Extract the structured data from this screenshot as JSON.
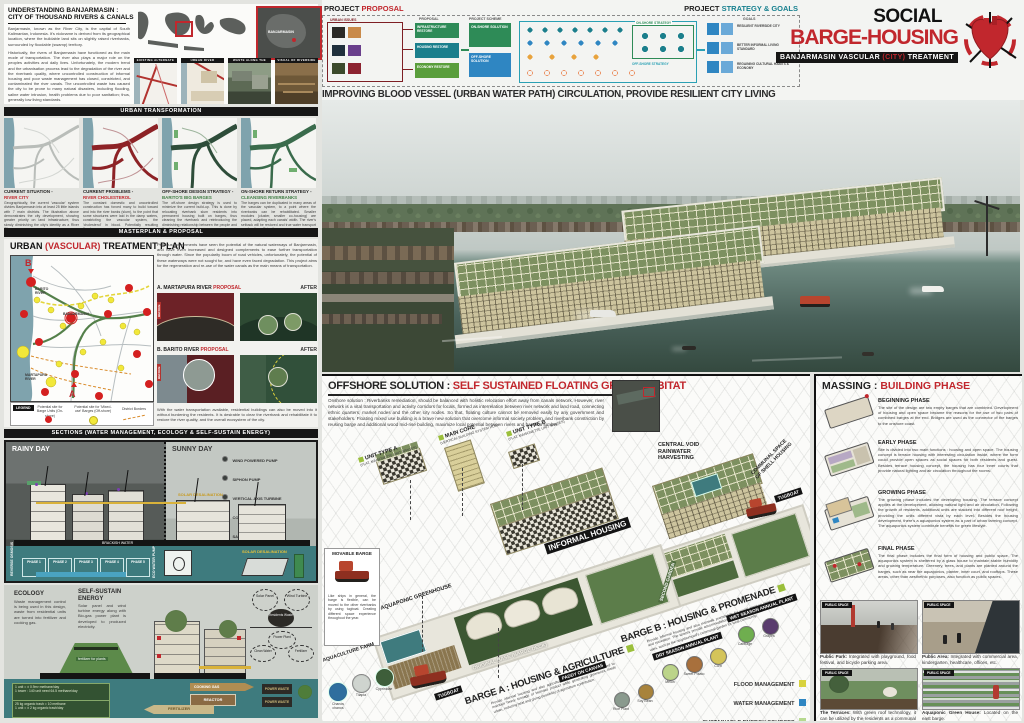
{
  "colors": {
    "accent_red": "#c1272d",
    "teal": "#17808f",
    "green": "#3f7d44",
    "flood": "#d8d23e",
    "water": "#2f86c2",
    "energy": "#b7d98f",
    "socio": "#55a14e",
    "map_river": "#7fa3ad"
  },
  "intro": {
    "title1": "UNDERSTANDING BANJARMASIN :",
    "title2": "CITY OF THOUSAND RIVERS & CANALS",
    "p1": "Banjarmasin, known as the River City, is the capital of South Kalimantan, Indonesia. It's nickname is derived from its geographical location, where the buildable land sits on slightly raised riverbanks, surrounded by floodable (swamp) territory.",
    "p2": "Historically, the rivers of Banjarmasin have functioned as the main mode of transportation. The river also plays a major role on the peoples activities and daily lives. Unfortunately, the modern trend and the urbanisation process lead to the degradation of the river and the riverbank quality, where uncontrolled construction of informal housing and poor waste management has closed, constricted, and contaminated the river canals. The uncontrolled waste has caused the city to be prone to many natural disasters, including flooding, saline water intrusion, health problems due to poor sanitation; thus, generally low living standards.",
    "inset_label": "BANJARMASIN",
    "thumbs": [
      "EXISTING ALTERNATE CANAL NETWORK",
      "URBAN RIVER CONSTRICTION",
      "WASTE ALONG THE CANALS",
      "VISUAL OF RIVERSIDE SETTLEMENTS"
    ]
  },
  "flow": {
    "left_title": "PROJECT ",
    "left_accent": "PROPOSAL",
    "right_title": "PROJECT ",
    "right_accent": "STRATEGY & GOALS",
    "col_issues": "URBAN ISSUES",
    "col_proposal": "PROPOSAL",
    "col_scheme": "PROJECT SCHEME",
    "goals_label": "GOALS",
    "strat_on": "ON-SHORE STRATEGY",
    "strat_off": "OFF-SHORE STRATEGY",
    "pboxes": [
      "INFRASTRUCTURE RESTORE",
      "HOUSING RESTORE",
      "ECONOMY RESTORE"
    ],
    "sboxes": [
      "ON-SHORE SOLUTION",
      "OFF-SHORE SOLUTION"
    ],
    "goals": [
      "RESILIENT RIVERSIDE CITY",
      "BETTER INFORMAL LIVING STANDARD",
      "REGAINING CULTURAL HABITS & ECONOMY"
    ],
    "tagline": "IMPROVING BLOOD VESSEL (URBAN WATER PATH) CIRCULATION, PROVIDE RESILIENT CITY LIVING"
  },
  "title_block": {
    "line1": "SOCIAL",
    "line2": "BARGE-HOUSING",
    "bar_pre": "BANJARMASIN VASCULAR ",
    "bar_accent": "(CITY)",
    "bar_post": " TREATMENT"
  },
  "ut": {
    "header": "URBAN TRANSFORMATION",
    "panels": [
      {
        "title": "CURRENT SITUATION -",
        "subtitle": "RIVER CITY",
        "text": "Geographically, the current 'vascular' system divides Banjarmasin into at least 25 little islands with 7 main districts. The illustration above demonstrates the city development, showing greater priority on land infrastructure, thus slowly diminishing the city's identity as a River City."
      },
      {
        "title": "CURRENT PROBLEMS -",
        "subtitle": "RIVER CHOLESTEROL",
        "text": "The constant domestic and uncontrolled construction has forced many to build toward and into the river banks (slum), to the point that some structures were laid in the damp waters, constricting the vascular system, the 'cholesterol' in blood. Potentially resulting floods."
      },
      {
        "title": "OFF-SHORE DESIGN STRATEGY -",
        "subtitle": "BARITO'S BIG BARGES",
        "text": "The off-shore design strategy is used to minimize the current build-up. This is done by relocating riverbank slum residents into permanent housing built on barges, thus cleaning the riverbank and reintroducing the diminishing relationship between the people and the river."
      },
      {
        "title": "ON-SHORE RETURN STRATEGY -",
        "subtitle": "CLEANSING RIVERBANKS",
        "text": "The barges can be duplicated in many areas of the vascular system, to a point where the riverbanks can be rehabilitated. Smaller modules (cluster, smaller co-housing) are placed, adapting each canals' width. The river's setback will be restored and true water transport can function efficiently."
      }
    ]
  },
  "masterplan_header": "MASTERPLAN & PROPOSAL",
  "treatment": {
    "title_pre": "URBAN ",
    "title_accent": "(VASCULAR)",
    "title_post": " TREATMENT PLAN",
    "intro": "Previous governments have seen the potential of the natural waterways of Banjarmasin, and have even increased and designed complements to ease further transportation through water. Since the popularity boom of road vehicles, unfortunately, the potential of these waterways were not sought for, and have even faced degradation. This project aims for the regeneration and re-use of the water canals as the main means of transportation.",
    "outro": "With the water transportation available, residential buildings can also be moved into it without burdening the residents. It is desirable to clear the riverbank and rehabilitate it to restore the river quality, and the overall ecosystem of the city.",
    "map": {
      "b": "B",
      "a": "A",
      "barito": "BARITO RIVER",
      "martapura": "MARTAPURA RIVER",
      "city": "BANJARMASIN"
    },
    "legend_title": "LEGEND",
    "legend": [
      {
        "label": "Potential site for Barge Units (On-shore)",
        "color": "#d42020"
      },
      {
        "label": "Potential site for 'Mixed-use' Barges (Off-shore)",
        "color": "#f2e83a"
      },
      {
        "label": "District Borders",
        "color": "#d98b2b"
      }
    ],
    "prop_a_pre": "A. MARTAPURA RIVER ",
    "prop_b_pre": "B. BARITO RIVER ",
    "prop_accent": "PROPOSAL",
    "before": "BEFORE",
    "after": "AFTER"
  },
  "sections": {
    "header": "SECTIONS (WATER MANAGEMENT, ECOLOGY & SELF-SUSTAIN ENERGY)",
    "rainy": "RAINY DAY",
    "sunny": "SUNNY DAY",
    "legend": [
      "WIND POWERED PUMP",
      "SIPHON PUMP",
      "VERTICAL AXIS TURBINE",
      "CONNECTOR NODE",
      "SAND AGGREGATE FILTER",
      "REVERSE OSMOSIS",
      "R.O RAINWATER FILTER"
    ],
    "labels": {
      "solar": "SOLAR DESALINATION",
      "brackish": "BRACKISH WATER",
      "pump": "ECO WATER PUMP",
      "osmosis": "REVERSE OSMOSIS"
    },
    "phases": [
      "PHASE 1",
      "PHASE 2",
      "PHASE 3",
      "PHASE 4",
      "PHASE 5"
    ]
  },
  "ecology": {
    "title": "ECOLOGY",
    "text": "Waste management control is being used in this design, waste from residential units are turned into fertilizer and cooking gas.",
    "info": [
      "1 unit = ± 0.9m³ methane/day",
      "1 tower : 140 unit need 64.5 methane/day",
      "25 kg organic trash = 10 methane",
      "1 unit = ± 2 kg organic trash/day"
    ],
    "fert_label": "fertilizer for plants"
  },
  "energy": {
    "title": "SELF-SUSTAIN ENERGY",
    "text": "Solar panel and wind turbine energy along with Bio-gas power plant is developed to produced electricity.",
    "diagram": {
      "gas": "COOKING GAS",
      "reactor": "REACTOR",
      "fert": "FERTILIZER",
      "power": "POWER WASTE"
    },
    "nodes": [
      "Solar Panel",
      "Wind Turbine",
      "Residents Waste",
      "Power Plant",
      "Clean Water",
      "Fertilizer"
    ]
  },
  "offshore": {
    "title_pre": "OFFSHORE SOLUTION : ",
    "title_accent": "SELF SUSTAINED FLOATING GREEN HABITAT",
    "paragraph": "Onshore solution : Riverbanks remediation, should be balanced with holistic relocation effort away from canals network. However, river network is a vital transportation and activity corridors for locals, formed as interrelation between river network and land road, connecting ethnic quarters, market nodes and the other city nodes. So that, floating culture cannot be removed easily by any government and stakeholders. Floating mixed use building is a brave new solution that overcome informal society problem, and riverbank constriction by reusing barge and additional wood mid-rise building, maximize local potential between rivers and bamboo lumber.",
    "lbl": {
      "unit_a": "UNIT TYPE A",
      "unit_a_sub": "(flat, maisonette unit spaces)",
      "main_core": "MAIN CORE",
      "main_core_sub": "(vertical building system hub)",
      "unit_b": "UNIT TYPE B",
      "unit_b_sub": "(flat, maisonette unit spaces)",
      "central": "CENTRAL VOID RAINWATER HARVESTING",
      "communal": "COMMUNAL SPACE OF SHELL HOUSING",
      "informal": "INFORMAL HOUSING",
      "greenhouse": "AQUAPONIC GREENHOUSE",
      "base": "ORIGINAL BASE (BARGE DECK)",
      "second_garden": "SECOND GARDEN",
      "tugboat": "TUGBOAT"
    },
    "movable": {
      "title": "MOVABLE BARGE",
      "caption": "Like ships in general, the barge is flexible, can be moved to the other riverbanks by using tugboat. Creating different space experience throughout the year."
    },
    "aqua": {
      "title": "AQUACULTURE FARM",
      "species": [
        "Chanos chanos",
        "Tilapia",
        "Cyprinidae"
      ]
    },
    "barge_a": {
      "title": "BARGE A : HOUSING & AGRICULTURE",
      "text": "Provide informal housing and also agriculture land inside urban area, used to maintain heavy tonnage of biomass product while generating greeneries inside urban, reducing heat and giving possibility of agriculture contribution."
    },
    "barge_b": {
      "title": "BARGE B : HOUSING & PROMENADE",
      "text": "Provide informal housing and also riverwalk promenade for social meet-up point and recreation. The spaces provide accommodation for additional and temporary uses, such as the neighborhood's communal garden for local community."
    },
    "paddy": {
      "title": "PADDY ON CANVAS",
      "crops": [
        "Rice Plant",
        "Soy Bean"
      ]
    },
    "dry": {
      "title": "DRY SEASON ANNUAL PLANT",
      "crops": [
        "Melon",
        "Sweet Potato",
        "Corn"
      ]
    },
    "wet": {
      "title": "WET SEASON ANNUAL PLANT",
      "crops": [
        "Cabbage",
        "Grapes"
      ]
    },
    "legend": [
      {
        "label": "FLOOD MANAGEMENT",
        "color": "#d8d23e"
      },
      {
        "label": "WATER MANAGEMENT",
        "color": "#2f86c2"
      },
      {
        "label": "SUSTAINABLE ENERGY SOURCES",
        "color": "#b7d98f"
      },
      {
        "label": "SOCIO-ECONOMIC FACILITIES",
        "color": "#55a14e"
      }
    ]
  },
  "massing": {
    "title_pre": "MASSING : ",
    "title_accent": "BUILDING PHASE",
    "phases": [
      {
        "name": "BEGINNING PHASE",
        "text": "The site of the design are two empty barges that are combined. Development of housing and open space became the reasons for the use of two pairs of combined barges at the end. Bridges are used as the connector of the barges to the onshore coast."
      },
      {
        "name": "EARLY PHASE",
        "text": "Site is divided into two main functions : housing and open space. The housing concept is terrace housing with interesting circulation inside, where the form could provide open spaces as social spaces for both residents and guest. Besides terrace housing concept, the housing has four inner courts that provide natural lighting and air circulation throughout the rooms."
      },
      {
        "name": "GROWING PHASE",
        "text": "The growing phase includes the developing housing. The terrace concept applies at the development, allowing natural light and air circulation. Following the growth of residents, additional units are stacked into different roof height, providing the units different vista by each level. Besides the housing development, there's a aquaponics system as a part of urban farming concept. The aquaponics system contribute benefits for green lifestyle."
      },
      {
        "name": "FINAL PHASE",
        "text": "The final phase includes the final form of housing and public space. The aquaponics system is sheltered by a glass house to maintain stable humidity and growing temperature. Greenery, trees, and plants are planted around the barges, such as near the aquaponics, planter, inner court, and rooftops. These areas, other than aesthethic purposes, also function as public spaces."
      }
    ],
    "photos": [
      {
        "tag": "PUBLIC SPACE",
        "lead": "Public Park:",
        "caption": " Integrated with playground, food festival, and bicycle parking area."
      },
      {
        "tag": "PUBLIC SPACE",
        "lead": "Public Area:",
        "caption": " Integrated with commercial area, kindergarten, healthcare, offices, etc."
      },
      {
        "tag": "PUBLIC SPACE",
        "lead": "The Terraces:",
        "caption": " With green roof technology, it can be utilized by the residents as a communal area."
      },
      {
        "tag": "PUBLIC SPACE",
        "lead": "Aquaponic Green House:",
        "caption": " Located on the east barge."
      }
    ]
  }
}
